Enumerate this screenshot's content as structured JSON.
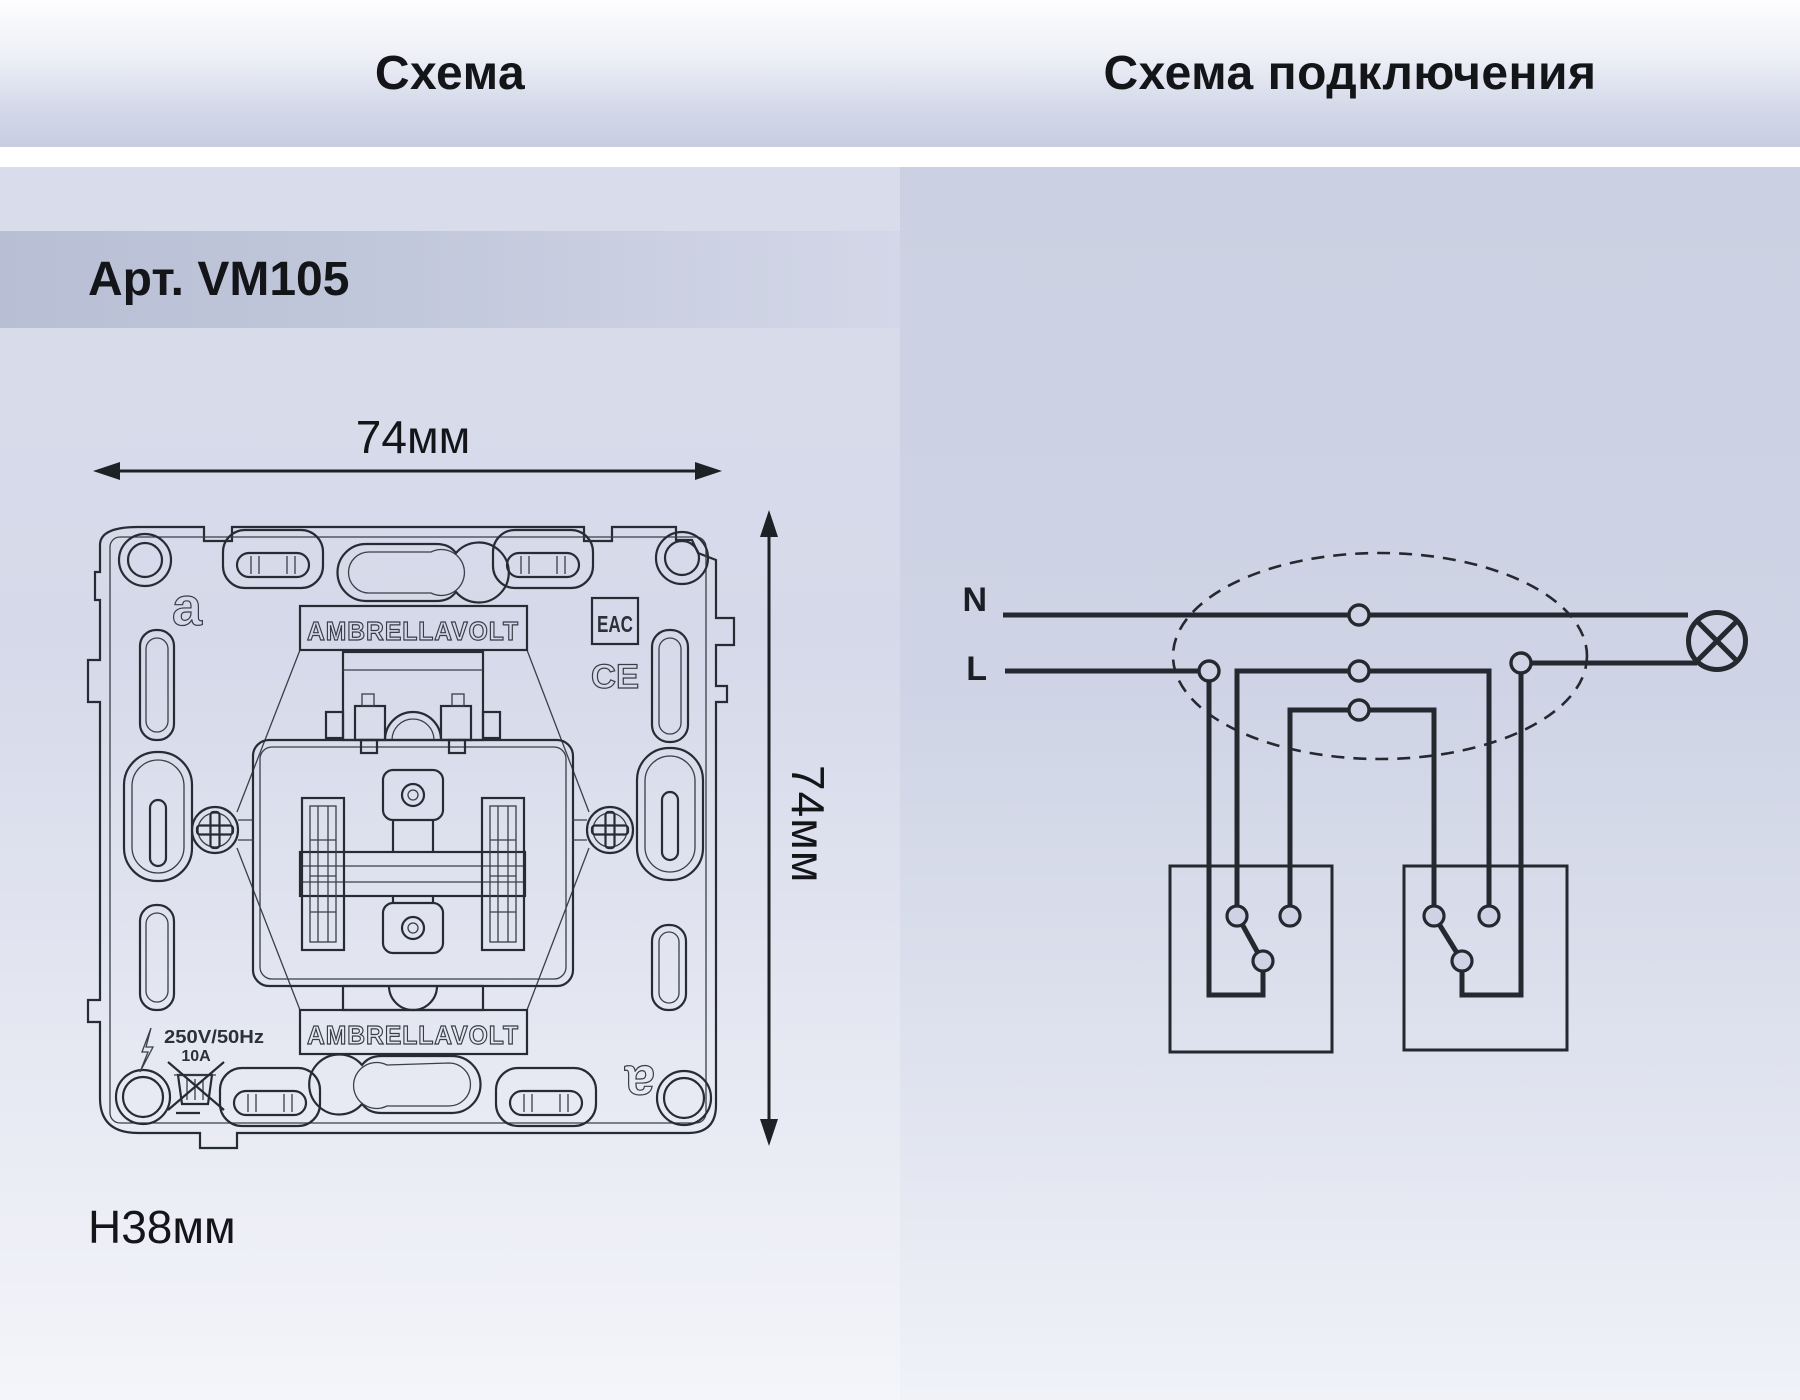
{
  "header": {
    "schema_title": "Схема",
    "wiring_title": "Схема подключения"
  },
  "product": {
    "article": "Арт. VM105"
  },
  "dimensions": {
    "width": "74мм",
    "height": "74мм",
    "depth": "H38мм"
  },
  "mechanism_marks": {
    "brand_top": "AMBRELLAVOLT",
    "brand_bottom": "AMBRELLAVOLT",
    "logo_glyph_top": "a",
    "logo_glyph_bottom": "a",
    "eac": "EAC",
    "ce": "CE",
    "voltage": "250V/50Hz",
    "current": "10A"
  },
  "wiring_labels": {
    "neutral": "N",
    "line": "L"
  },
  "colors": {
    "accent_band": "#b8bfd5",
    "panel_top_left": "#d9ddeb",
    "panel_top_right": "#cbd1e2",
    "ink": "#23262c"
  }
}
